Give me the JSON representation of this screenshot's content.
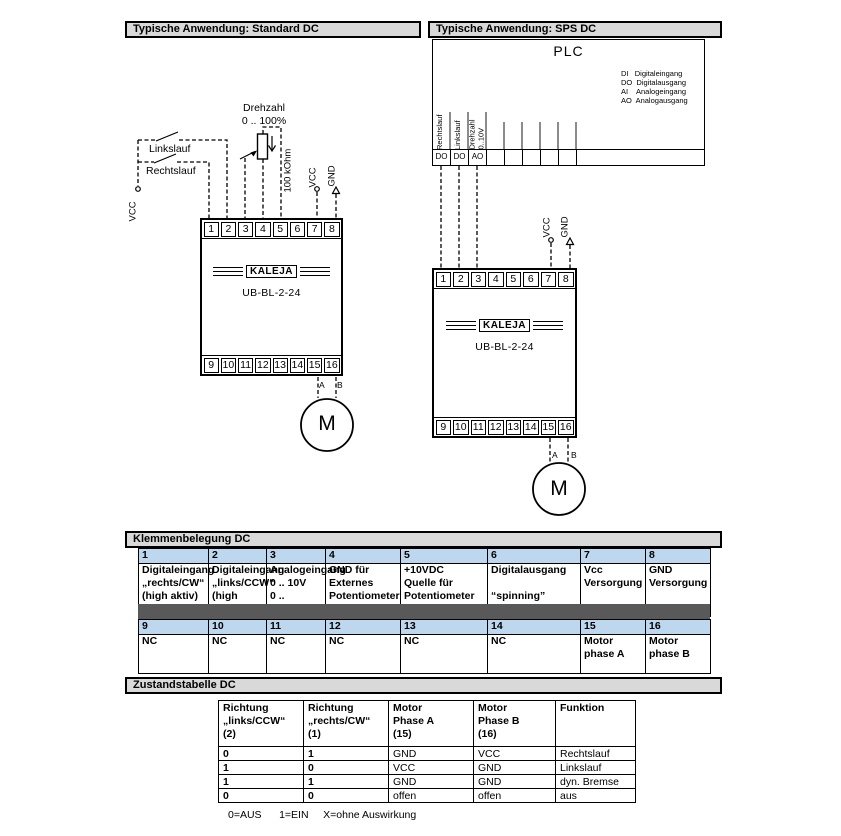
{
  "colors": {
    "bar_bg": "#D9D9D9",
    "table_header_bg": "#BDD7EE",
    "separator_bg": "#595959",
    "line": "#000000"
  },
  "section_headers": {
    "standard": "Typische Anwendung: Standard DC",
    "sps": "Typische Anwendung: SPS DC",
    "klemmen": "Klemmenbelegung DC",
    "zustand": "Zustandstabelle DC"
  },
  "device": {
    "brand": "KALEJA",
    "model": "UB-BL-2-24",
    "terminals_top": [
      "1",
      "2",
      "3",
      "4",
      "5",
      "6",
      "7",
      "8"
    ],
    "terminals_bottom": [
      "9",
      "10",
      "11",
      "12",
      "13",
      "14",
      "15",
      "16"
    ]
  },
  "motor": {
    "label": "M",
    "phase_a": "A",
    "phase_b": "B"
  },
  "left_diagram": {
    "switch_links": "Linkslauf",
    "switch_rechts": "Rechtslauf",
    "vcc_feed": "VCC",
    "pot_title": "Drehzahl\n0 .. 100%",
    "pot_value": "100 kOhm",
    "vcc": "VCC",
    "gnd": "GND"
  },
  "right_diagram": {
    "plc_title": "PLC",
    "plc_legend": [
      "DI   Digitaleingang",
      "DO  Digitalausgang",
      "AI    Analogeingang",
      "AO  Analogausgang"
    ],
    "plc_port_labels": [
      "Rechtslauf",
      "Linkslauf",
      "Drehzahl\n0..10V"
    ],
    "plc_cells": [
      "DO",
      "DO",
      "AO",
      "",
      "",
      "",
      "",
      "",
      ""
    ],
    "vcc": "VCC",
    "gnd": "GND"
  },
  "klemmen_table": {
    "row1_numbers": [
      "1",
      "2",
      "3",
      "4",
      "5",
      "6",
      "7",
      "8"
    ],
    "row1_cells": [
      "Digitaleingang\n„rechts/CW“\n(high aktiv)",
      "Digitaleingang\n„links/CCW“\n(high aktiv)",
      "Analogeingang\n0 .. 10V\n0 .. 100%PWM",
      "GND für\nExternes\nPotentiometer",
      "+10VDC\nQuelle für\nPotentiometer",
      "Digitalausgang\n\n“spinning”",
      "Vcc\nVersorgung",
      "GND\nVersorgung"
    ],
    "row2_numbers": [
      "9",
      "10",
      "11",
      "12",
      "13",
      "14",
      "15",
      "16"
    ],
    "row2_cells": [
      "NC",
      "NC",
      "NC",
      "NC",
      "NC",
      "NC",
      "Motor\nphase A",
      "Motor\nphase B"
    ]
  },
  "zustand_table": {
    "columns": [
      "Richtung\n„links/CCW“\n (2)",
      "Richtung\n„rechts/CW“\n (1)",
      "Motor\nPhase A\n(15)",
      "Motor\nPhase B\n(16)",
      "Funktion"
    ],
    "rows": [
      [
        "0",
        "1",
        "GND",
        "VCC",
        "Rechtslauf"
      ],
      [
        "1",
        "0",
        "VCC",
        "GND",
        "Linkslauf"
      ],
      [
        "1",
        "1",
        "GND",
        "GND",
        "dyn. Bremse"
      ],
      [
        "0",
        "0",
        "offen",
        "offen",
        "aus"
      ]
    ]
  },
  "footnote": "0=AUS      1=EIN     X=ohne Auswirkung"
}
